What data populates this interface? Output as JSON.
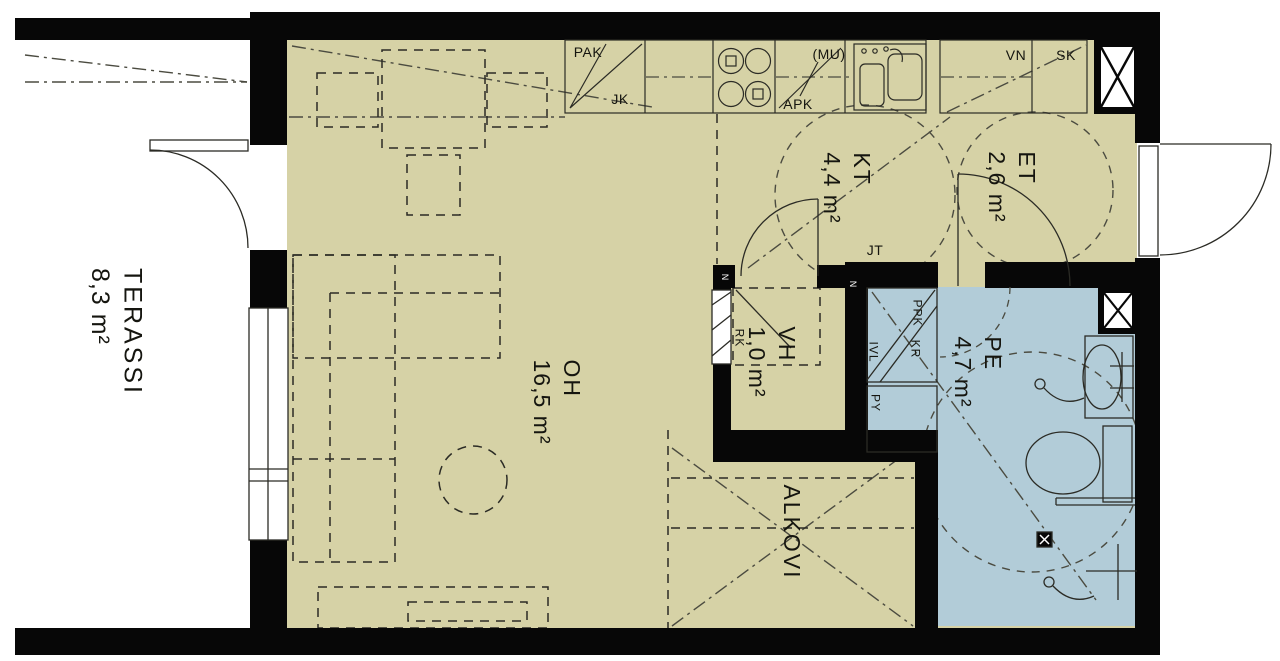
{
  "colors": {
    "floor": "#d6d2a6",
    "wet_room": "#b2ccd8",
    "wall": "#070707",
    "line": "#2b2b25"
  },
  "rooms": {
    "terassi": {
      "name": "TERASSI",
      "area": "8,3 m²"
    },
    "oh": {
      "name": "OH",
      "area": "16,5 m²"
    },
    "kt": {
      "name": "KT",
      "area": "4,4 m²"
    },
    "et": {
      "name": "ET",
      "area": "2,6 m²"
    },
    "vh": {
      "name": "VH",
      "area": "1,0 m²"
    },
    "pe": {
      "name": "PE",
      "area": "4,7 m²"
    },
    "alkovi": {
      "name": "ALKOVI"
    }
  },
  "kitchen": {
    "pak": "PAK",
    "jk": "JK",
    "apk": "APK",
    "mu": "(MU)",
    "vn": "VN",
    "sk": "SK"
  },
  "utility": {
    "jt": "JT",
    "rk": "RK",
    "ppk": "PPK",
    "kr": "KR",
    "ivl": "IVL",
    "py": "PY"
  },
  "door_mark": "N"
}
